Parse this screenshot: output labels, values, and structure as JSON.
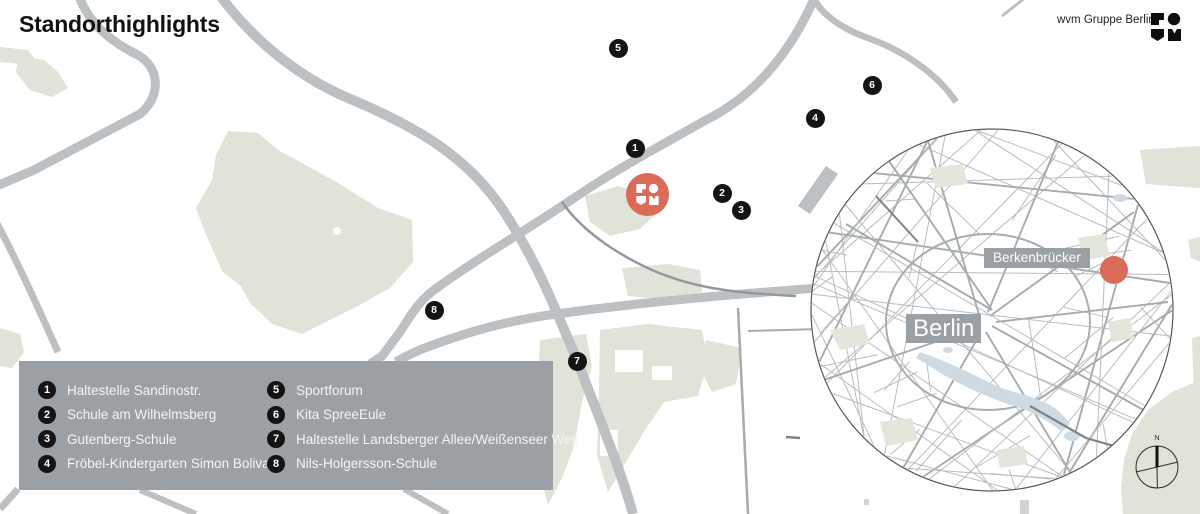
{
  "page": {
    "title": "Standorthighlights",
    "credit": "wvm Gruppe Berlin"
  },
  "inset": {
    "city_label": "Berlin",
    "district_label": "Berkenbrücker"
  },
  "compass": {
    "north_label": "N"
  },
  "legend": {
    "items": [
      {
        "num": "1",
        "label": "Haltestelle Sandinostr."
      },
      {
        "num": "2",
        "label": "Schule am Wilhelmsberg"
      },
      {
        "num": "3",
        "label": "Gutenberg-Schule"
      },
      {
        "num": "4",
        "label": "Fröbel-Kindergarten Simon Bolivar"
      },
      {
        "num": "5",
        "label": "Sportforum"
      },
      {
        "num": "6",
        "label": "Kita SpreeEule"
      },
      {
        "num": "7",
        "label": "Haltestelle Landsberger Allee/Weißenseer Weg"
      },
      {
        "num": "8",
        "label": "Nils-Holgersson-Schule"
      }
    ]
  },
  "map": {
    "markers": [
      {
        "num": "1",
        "x": 635,
        "y": 148
      },
      {
        "num": "2",
        "x": 722,
        "y": 193
      },
      {
        "num": "3",
        "x": 741,
        "y": 210
      },
      {
        "num": "4",
        "x": 815,
        "y": 118
      },
      {
        "num": "5",
        "x": 618,
        "y": 48
      },
      {
        "num": "6",
        "x": 872,
        "y": 85
      },
      {
        "num": "7",
        "x": 577,
        "y": 361
      },
      {
        "num": "8",
        "x": 434,
        "y": 310
      }
    ]
  },
  "colors": {
    "accent": "#d96b58",
    "legend_bg": "#9aa0a3",
    "badge_bg": "#141414",
    "road_gray": "#bcc0c3",
    "green": "#dfe3d8"
  }
}
